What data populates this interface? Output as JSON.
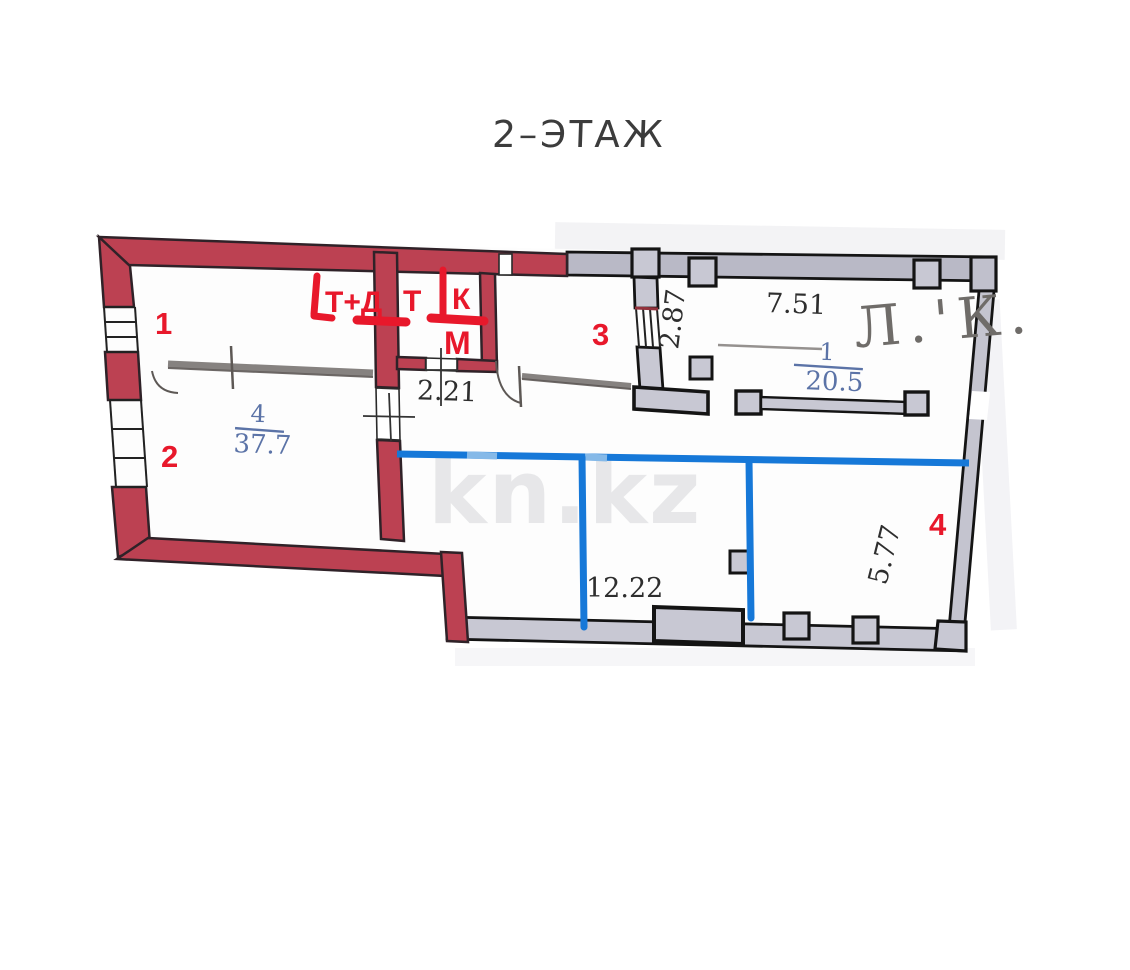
{
  "title": "2–ЭТАЖ",
  "watermark": "kn.kz",
  "handwriting_note": "Л.'К.",
  "room_labels": {
    "apartment_room": {
      "number": "4",
      "area": "37.7"
    },
    "stair_room": {
      "number": "1",
      "area": "20.5"
    }
  },
  "dimensions": {
    "passage_width": "2.21",
    "window_width": "2.87",
    "hall_width": "7.51",
    "open_space_width": "12.22",
    "right_side_depth": "5.77"
  },
  "red_marks": {
    "point_1": "1",
    "point_2": "2",
    "point_3": "3",
    "point_4": "4",
    "label_td": "Т+Д",
    "label_t": "Т",
    "label_k": "К",
    "label_m": "М"
  },
  "colors": {
    "wall_red": "#bc4152",
    "wall_gray": "#c8c8d3",
    "marker_red": "#e8182b",
    "marker_blue": "#1678d8",
    "print_blue": "#5b73a7",
    "pencil": "#5d5855"
  }
}
